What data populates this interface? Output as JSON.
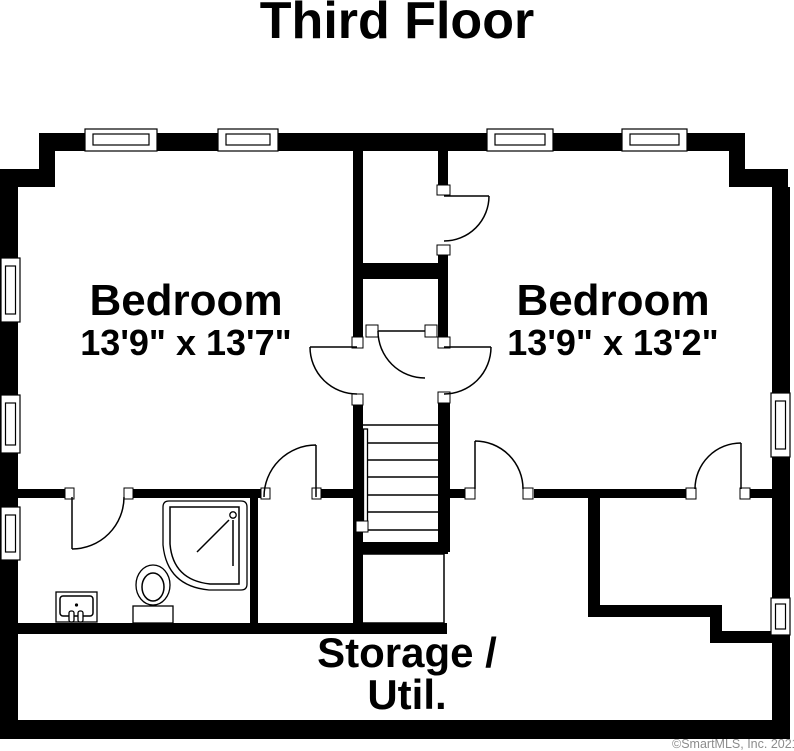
{
  "title": "Third Floor",
  "rooms": [
    {
      "id": "bedroom-left",
      "name": "Bedroom",
      "dimensions": "13'9\" x 13'7\""
    },
    {
      "id": "bedroom-right",
      "name": "Bedroom",
      "dimensions": "13'9\" x 13'2\""
    },
    {
      "id": "storage-util",
      "label_line1": "Storage /",
      "label_line2": "Util."
    }
  ],
  "fixtures": [
    "shower",
    "toilet",
    "sink-vanity",
    "stairs"
  ],
  "watermark": "©SmartMLS, Inc. 2021",
  "colors": {
    "wall": "#000000",
    "background": "#ffffff",
    "watermark": "#8c8c8c"
  }
}
